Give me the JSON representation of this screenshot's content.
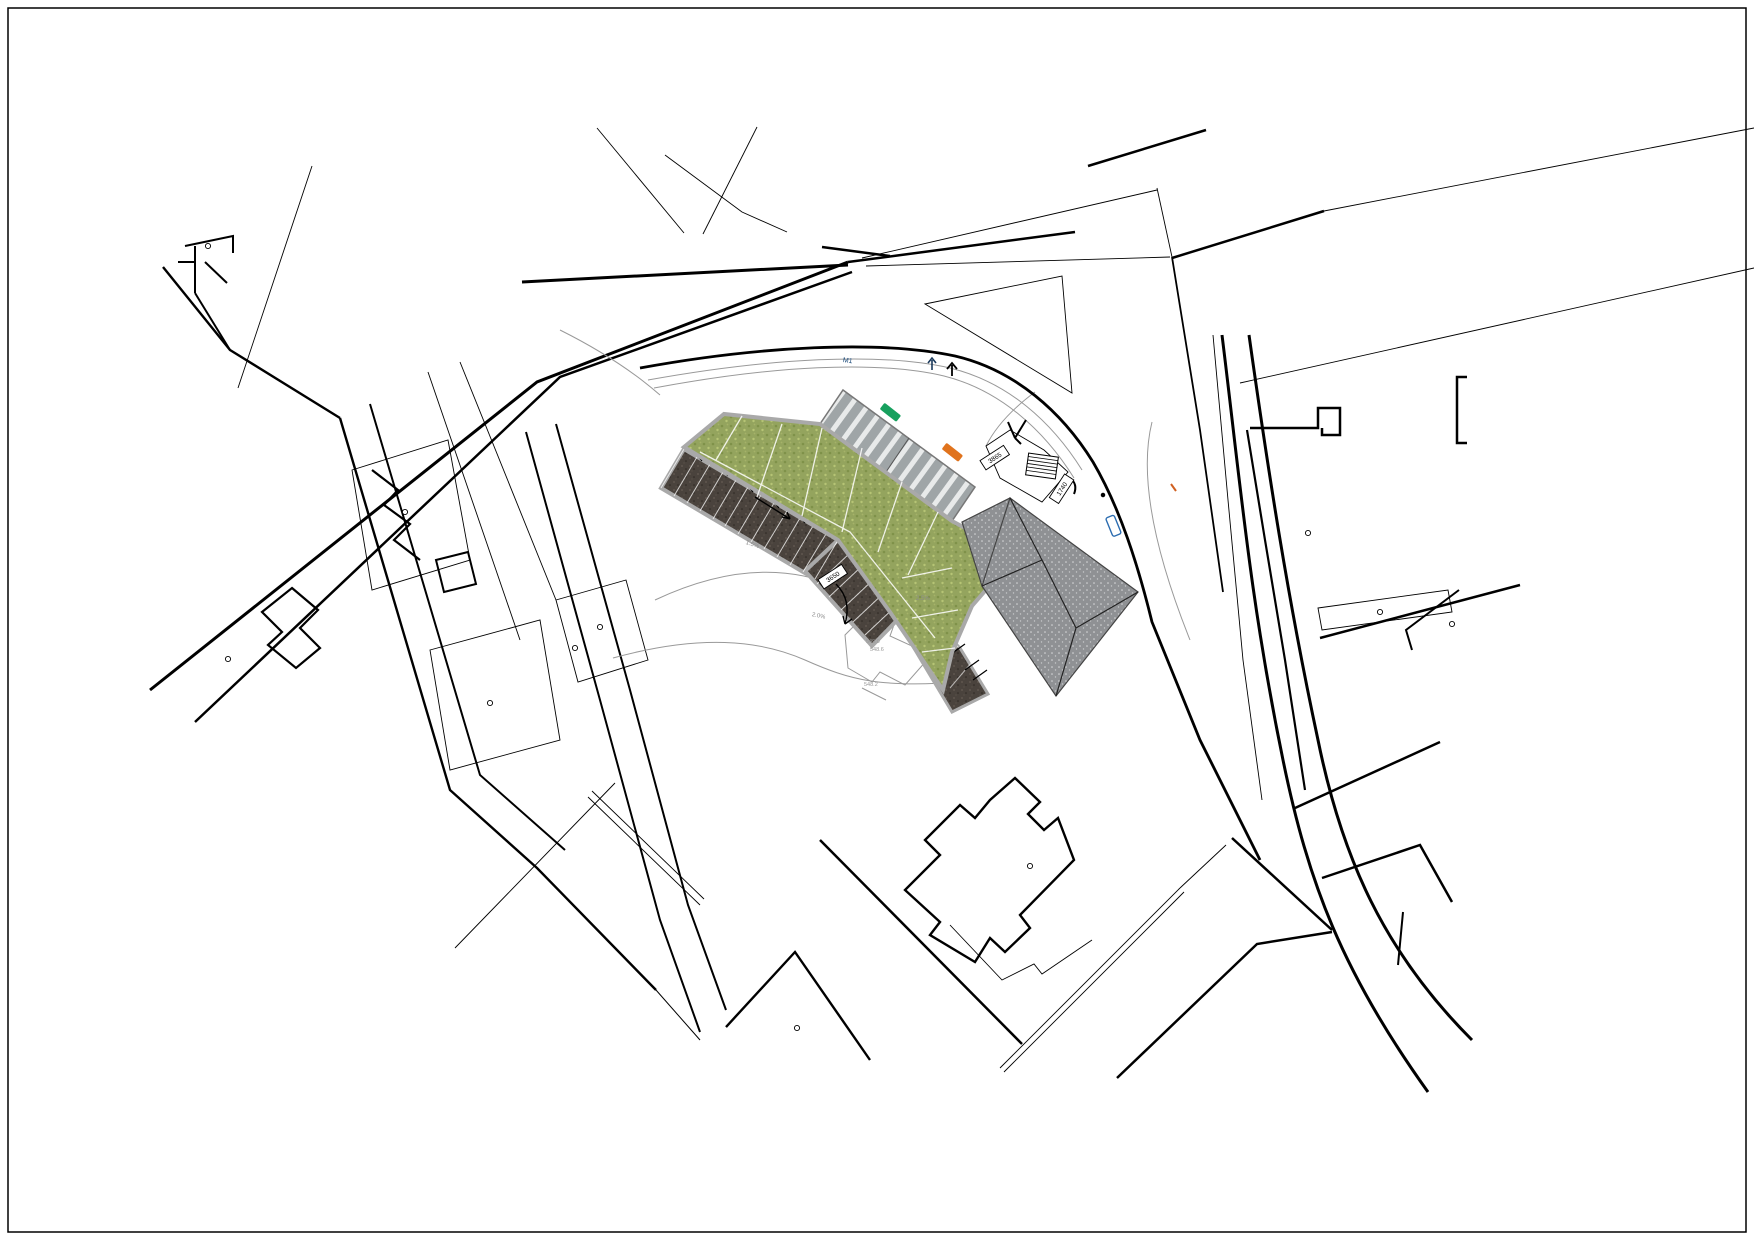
{
  "sheet": {
    "type_label": "site-plan",
    "background": "#ffffff",
    "ink": "#000000",
    "contour_gray": "#999999",
    "walkway_gray": "#a9a9a9"
  },
  "labels": {
    "plate_deck": "3865",
    "plate_stairs": "1740",
    "plate_parking": "3650",
    "road_mark": "M1",
    "grade_1": "1.5%",
    "grade_2": "2.0%",
    "grade_3": "2.5%",
    "house_note_1": "549.0",
    "house_note_2": "548.6",
    "house_note_3": "548.2"
  },
  "colors": {
    "lawn": "#94a45e",
    "lawn_dark": "#7c8f47",
    "lawn_light": "#bac878",
    "parking_asphalt": "#4a433d",
    "deck_stripe_dark": "#9fa5a7",
    "deck_stripe_light": "#e8eaea",
    "roof_gray": "#8f9194",
    "car_orange": "#e0731d",
    "car_teal": "#12a376",
    "car_purple": "#7c1f9c",
    "car_skyblue": "#7fb2e5",
    "car_red": "#d61f1f",
    "car_navy": "#1f5ea8",
    "car_green": "#0faa55",
    "car_yellow": "#f4e01c",
    "car_deck_green": "#17a05e",
    "car_deck_orange": "#e0731d",
    "street_item_blue": "#1b4a7a",
    "orange_tick": "#d06020",
    "label_gray": "#8a8a8a"
  }
}
